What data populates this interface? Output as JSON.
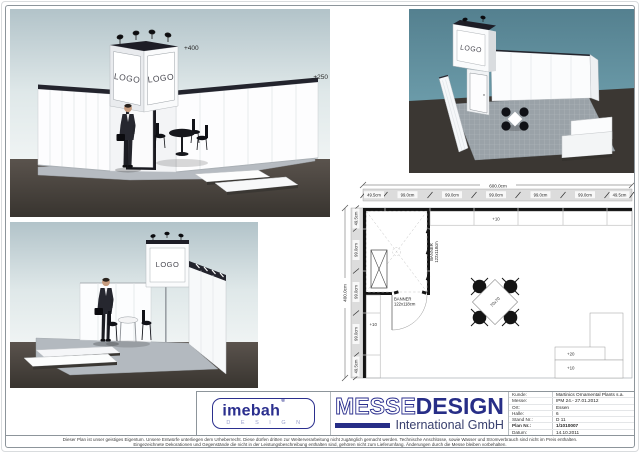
{
  "renders": {
    "logo": "LOGO",
    "tower_height": "+400",
    "wall_height": "+250"
  },
  "plan": {
    "dim_total_width": "600.0cm",
    "dim_total_depth": "400.0cm",
    "dim_top": [
      "49.5cm",
      "99.0cm",
      "99.0cm",
      "99.0cm",
      "99.0cm",
      "99.0cm",
      "49.5cm"
    ],
    "dim_left": [
      "49.5cm",
      "99.0cm",
      "99.0cm",
      "99.0cm",
      "49.5cm"
    ],
    "label_platform_top": "+10",
    "label_platform_left": "+10",
    "label_step_high": "+20",
    "label_step_low": "+10",
    "banner_side": {
      "line1": "BANNER",
      "line2": "122x118cm"
    },
    "banner_bottom": {
      "line1": "BANNER",
      "line2": "122x118cm"
    },
    "table_label": "70x70"
  },
  "title_block": {
    "imebah_logo": {
      "word": "imebah",
      "mark": "®",
      "subtitle": "D E S I G N"
    },
    "messe_logo": {
      "outline_part": "MESSE",
      "solid_part": "DESIGN",
      "subtitle": "International GmbH"
    },
    "info_rows": [
      {
        "label": "Kunde:",
        "value": "Martinics Ornamental Plants s.a."
      },
      {
        "label": "Messe:",
        "value": "IPM 24.- 27.01.2012"
      },
      {
        "label": "Ort:",
        "value": "Essen"
      },
      {
        "label": "Halle:",
        "value": "6"
      },
      {
        "label": "Stand Nr.:",
        "value": "D 11"
      },
      {
        "label": "Plan Nr.:",
        "value": "1/1010007"
      },
      {
        "label": "Datum:",
        "value": "14.10.2011"
      }
    ]
  },
  "footer": {
    "line1": "Dieser Plan ist unser geistiges Eigentum. Unsere Entwürfe unterliegen dem Urheberrecht. Diese dürfen dritten zur Weiterverarbeitung nicht zugänglich gemacht werden. Technische Anschlüsse, sowie Wasser und Stromverbrauch sind nicht im Preis enthalten.",
    "line2": "Eingezeichnete Dekorationen und Gegenstände die nicht in der Leistungsbeschreibung enthalten sind, gehören nicht zum Lieferumfang. Änderungen durch die Messe bleiben vorbehalten."
  },
  "colors": {
    "brand_navy": "#272e87",
    "sky_teal": "#5d8ba0",
    "sky_light": "#b2c3c9",
    "floor_dark": "#3b3733",
    "plan_line": "#999999"
  }
}
